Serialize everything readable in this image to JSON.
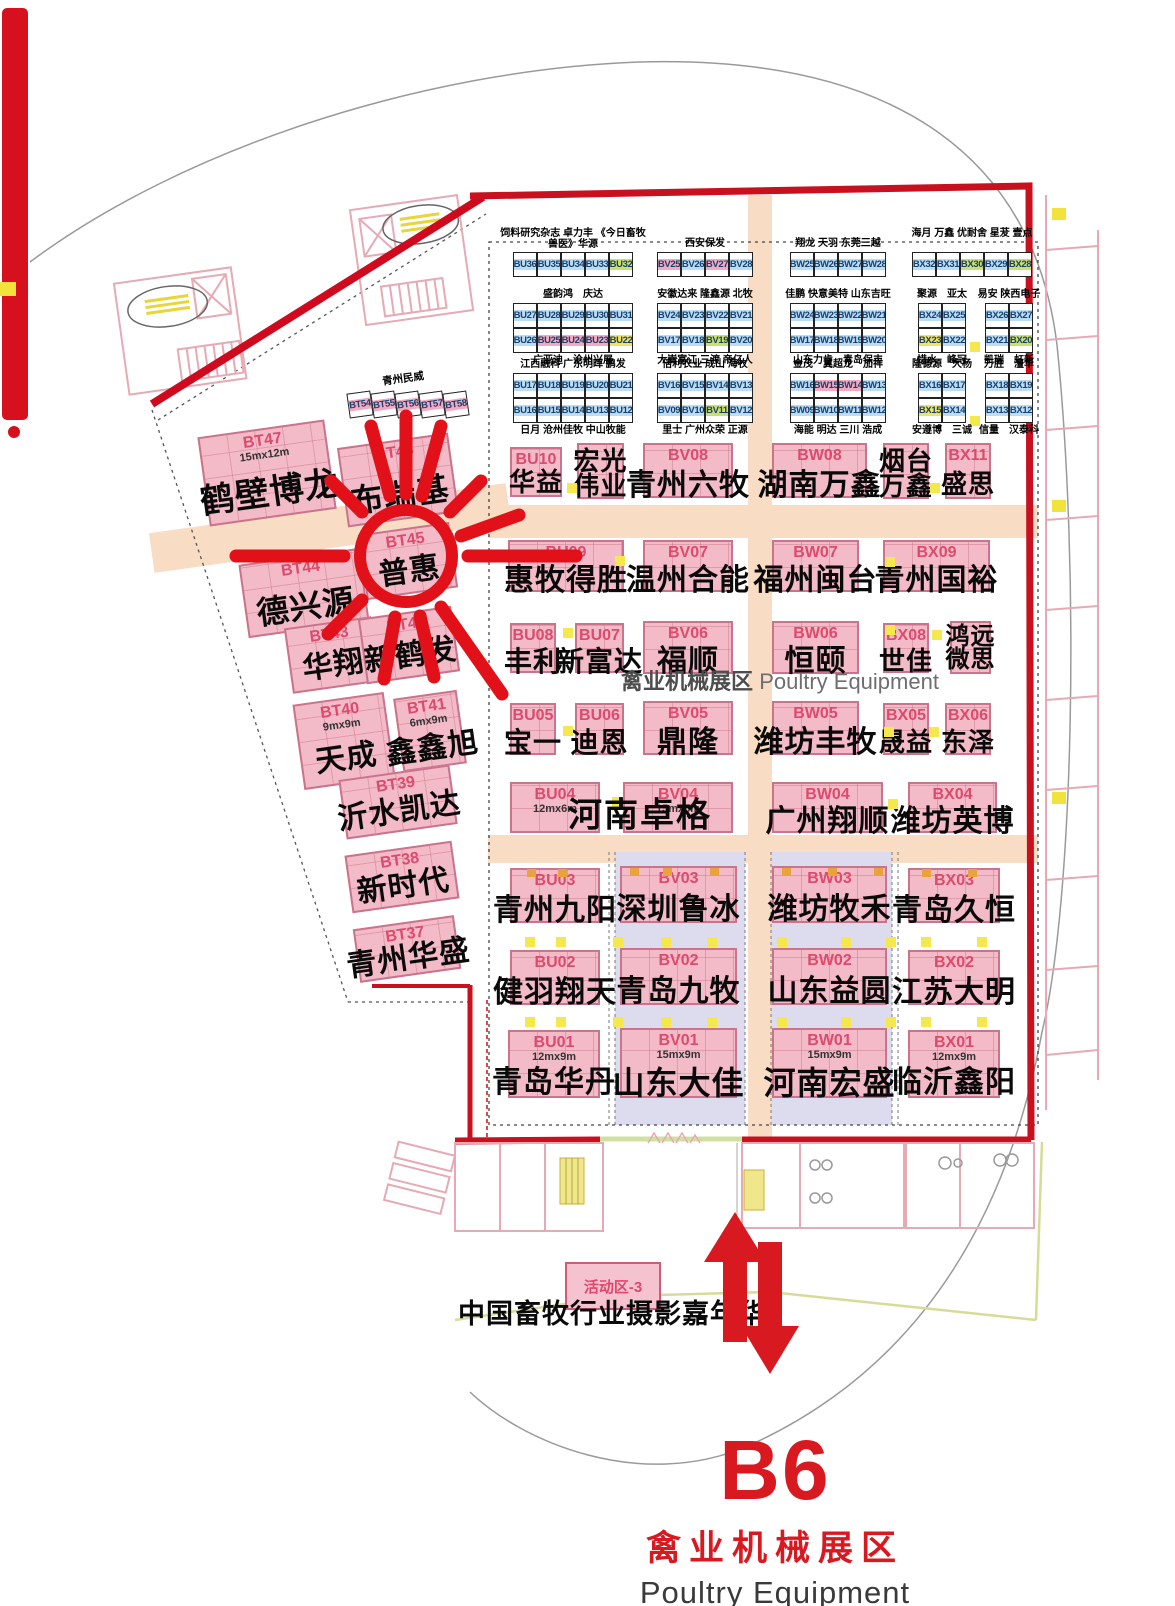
{
  "zone_center_label": {
    "cn": "禽业机械展区",
    "en": "Poultry Equipment"
  },
  "footer": {
    "hall_code": "B6",
    "zone_cn": "禽业机械展区",
    "zone_en": "Poultry Equipment"
  },
  "activity": {
    "booth_label": "活动区-3",
    "title": "中国畜牧行业摄影嘉年华"
  },
  "left_zone": {
    "strip_label": "青州民威",
    "strip_cells": [
      "BT54",
      "BT55",
      "BT56",
      "BT57",
      "BT58"
    ]
  },
  "colors": {
    "booth_pink": "#f3bac7",
    "booth_border": "#c9748c",
    "code_red": "#dd4a6e",
    "corridor_peach": "#f8dcc3",
    "lavender": "#dcdcee",
    "accent_red": "#d91920",
    "boundary_red": "#c9101e",
    "cell_blue": "#badcf4",
    "cell_pink": "#f4a9c0",
    "cell_green": "#cbe06c",
    "cell_yellow": "#f2e35e"
  },
  "top_grid": {
    "highlights": {
      "BU25": "pink",
      "BU24": "pink",
      "BU23": "pink",
      "BU22": "yellow",
      "BV25": "pink",
      "BV27": "pink",
      "BW15": "pink",
      "BW14": "pink",
      "BU32": "green",
      "BV19": "green",
      "BV11": "green",
      "BX30": "green",
      "BX28": "green",
      "BX20": "green",
      "BX23": "yellow",
      "BX15": "yellow"
    },
    "groups": [
      {
        "id": "BU-1",
        "x": 513,
        "y": 252,
        "wrap": true,
        "rows": [
          [
            "BU36",
            "BU35",
            "BU34",
            "BU33",
            "BU32"
          ]
        ],
        "above": "饲料研究杂志 卓力丰 《今日畜牧兽医》华源",
        "below": ""
      },
      {
        "id": "BU-2",
        "x": 513,
        "y": 303,
        "rows": [
          [
            "BU27",
            "BU28",
            "BU29",
            "BU30",
            "BU31"
          ],
          [
            "BU26",
            "BU25",
            "BU24",
            "BU23",
            "BU22"
          ]
        ],
        "above": "盛韵鸿　庆达",
        "below": "广亚迪　沧州兴展"
      },
      {
        "id": "BU-3",
        "x": 513,
        "y": 373,
        "rows": [
          [
            "BU17",
            "BU18",
            "BU19",
            "BU20",
            "BU21"
          ],
          [
            "BU16",
            "BU15",
            "BU14",
            "BU13",
            "BU12"
          ]
        ],
        "above": "江西融科 广东明晖 鹏发",
        "below": "日月 沧州佳牧 中山牧能"
      },
      {
        "id": "BV-1",
        "x": 657,
        "y": 252,
        "rows": [
          [
            "BV25",
            "BV26",
            "BV27",
            "BV28"
          ]
        ],
        "above": "西安保发",
        "below": ""
      },
      {
        "id": "BV-2",
        "x": 657,
        "y": 303,
        "rows": [
          [
            "BV24",
            "BV23",
            "BV22",
            "BV21"
          ],
          [
            "BV17",
            "BV18",
            "BV19",
            "BV20"
          ]
        ],
        "above": "安徽达来 隆鑫源 北牧",
        "below": "大嵩富江 三渡 帝亿人"
      },
      {
        "id": "BV-3",
        "x": 657,
        "y": 373,
        "rows": [
          [
            "BV16",
            "BV15",
            "BV14",
            "BV13"
          ],
          [
            "BV09",
            "BV10",
            "BV11",
            "BV12"
          ]
        ],
        "above": "倍利农业 成山 海牧",
        "below": "里士 广州众荣 正源"
      },
      {
        "id": "BW-1",
        "x": 790,
        "y": 252,
        "rows": [
          [
            "BW25",
            "BW26",
            "BW27",
            "BW28"
          ]
        ],
        "above": "翔龙 天羽 东莞三越",
        "below": ""
      },
      {
        "id": "BW-2",
        "x": 790,
        "y": 303,
        "rows": [
          [
            "BW24",
            "BW23",
            "BW22",
            "BW21"
          ],
          [
            "BW17",
            "BW18",
            "BW19",
            "BW20"
          ]
        ],
        "above": "佳鹏 快意美特 山东吉旺",
        "below": "山东力肯　青岛保丰"
      },
      {
        "id": "BW-3",
        "x": 790,
        "y": 373,
        "rows": [
          [
            "BW16",
            "BW15",
            "BW14",
            "BW13"
          ],
          [
            "BW09",
            "BW10",
            "BW11",
            "BW12"
          ]
        ],
        "above": "金茂　翼超龙　加祥",
        "below": "海能 明达 三川 浩成"
      },
      {
        "id": "BX-1",
        "x": 912,
        "y": 252,
        "wrap": true,
        "rows": [
          [
            "BX32",
            "BX31",
            "BX30",
            "BX29",
            "BX28"
          ]
        ],
        "above": "海月 万鑫 优耐舍 星茇 壹点",
        "below": ""
      },
      {
        "id": "BX-2L",
        "x": 918,
        "y": 303,
        "rows": [
          [
            "BX24",
            "BX25"
          ],
          [
            "BX23",
            "BX22"
          ]
        ],
        "above": "聚源　亚太",
        "below": "惜水　峰冠"
      },
      {
        "id": "BX-2R",
        "x": 985,
        "y": 303,
        "rows": [
          [
            "BX26",
            "BX27"
          ],
          [
            "BX21",
            "BX20"
          ]
        ],
        "above": "易安 陕西电子",
        "below": "凯瑞　虹新"
      },
      {
        "id": "BX-3L",
        "x": 918,
        "y": 373,
        "rows": [
          [
            "BX16",
            "BX17"
          ],
          [
            "BX15",
            "BX14"
          ]
        ],
        "above": "隆德源　大杨",
        "below": "安遵博　三诚"
      },
      {
        "id": "BX-3R",
        "x": 985,
        "y": 373,
        "rows": [
          [
            "BX18",
            "BX19"
          ],
          [
            "BX13",
            "BX12"
          ]
        ],
        "above": "万胜　澶华",
        "below": "信量　汉泰科"
      }
    ]
  },
  "booths": [
    {
      "code": "BU10",
      "name": "华益",
      "x": 510,
      "y": 447,
      "w": 52,
      "h": 50,
      "fs": 26,
      "ny": 45
    },
    {
      "code": "",
      "name": "宏光\n伟业",
      "x": 577,
      "y": 443,
      "w": 47,
      "h": 56,
      "fs": 26,
      "ny": 8
    },
    {
      "code": "BV08",
      "name": "青州六牧",
      "x": 643,
      "y": 443,
      "w": 90,
      "h": 55,
      "fs": 30
    },
    {
      "code": "BW08",
      "name": "湖南万鑫",
      "x": 772,
      "y": 443,
      "w": 95,
      "h": 55,
      "fs": 30
    },
    {
      "code": "",
      "name": "烟台\n万鑫",
      "x": 883,
      "y": 443,
      "w": 46,
      "h": 56,
      "fs": 26,
      "ny": 8
    },
    {
      "code": "BX11",
      "name": "盛思",
      "x": 945,
      "y": 443,
      "w": 46,
      "h": 56,
      "fs": 26
    },
    {
      "code": "BU09",
      "name": "惠牧得胜",
      "x": 508,
      "y": 540,
      "w": 116,
      "h": 52,
      "fs": 30
    },
    {
      "code": "BV07",
      "name": "温州合能",
      "x": 643,
      "y": 540,
      "w": 90,
      "h": 52,
      "fs": 30
    },
    {
      "code": "BW07",
      "name": "福州闽台",
      "x": 772,
      "y": 540,
      "w": 87,
      "h": 52,
      "fs": 30
    },
    {
      "code": "BX09",
      "name": "青州国裕",
      "x": 883,
      "y": 540,
      "w": 107,
      "h": 52,
      "fs": 30
    },
    {
      "code": "BU08",
      "name": "丰利",
      "x": 510,
      "y": 623,
      "w": 46,
      "h": 50,
      "fs": 28
    },
    {
      "code": "BU07",
      "name": "新富达",
      "x": 575,
      "y": 623,
      "w": 49,
      "h": 50,
      "fs": 28
    },
    {
      "code": "BV06",
      "name": "福顺",
      "x": 643,
      "y": 621,
      "w": 90,
      "h": 53,
      "fs": 30
    },
    {
      "code": "BW06",
      "name": "恒颐",
      "x": 772,
      "y": 621,
      "w": 87,
      "h": 53,
      "fs": 30
    },
    {
      "code": "BX08",
      "name": "世佳",
      "x": 883,
      "y": 623,
      "w": 46,
      "h": 50,
      "fs": 26
    },
    {
      "code": "",
      "name": "鸿远\n微思",
      "x": 950,
      "y": 621,
      "w": 41,
      "h": 53,
      "fs": 24,
      "ny": 6
    },
    {
      "code": "BU05",
      "name": "宝一",
      "x": 510,
      "y": 703,
      "w": 46,
      "h": 52,
      "fs": 28
    },
    {
      "code": "BU06",
      "name": "迪恩",
      "x": 575,
      "y": 703,
      "w": 49,
      "h": 52,
      "fs": 28
    },
    {
      "code": "BV05",
      "name": "鼎隆",
      "x": 643,
      "y": 701,
      "w": 90,
      "h": 54,
      "fs": 30
    },
    {
      "code": "BW05",
      "name": "潍坊丰牧",
      "x": 772,
      "y": 701,
      "w": 87,
      "h": 54,
      "fs": 30
    },
    {
      "code": "BX05",
      "name": "晟益",
      "x": 883,
      "y": 703,
      "w": 46,
      "h": 52,
      "fs": 26
    },
    {
      "code": "BX06",
      "name": "东泽",
      "x": 945,
      "y": 703,
      "w": 46,
      "h": 52,
      "fs": 26
    },
    {
      "code": "BU04",
      "name": "",
      "size": "12mx6m",
      "x": 510,
      "y": 782,
      "w": 90,
      "h": 51
    },
    {
      "code": "BV04",
      "name": "",
      "size": "15mx6m",
      "x": 623,
      "y": 782,
      "w": 110,
      "h": 51
    },
    {
      "code": "BW04",
      "name": "广州翔顺",
      "x": 772,
      "y": 782,
      "w": 111,
      "h": 51,
      "fs": 30
    },
    {
      "code": "BX04",
      "name": "潍坊英博",
      "x": 908,
      "y": 782,
      "w": 89,
      "h": 51,
      "fs": 30
    },
    {
      "code": "BU03",
      "name": "青州九阳",
      "x": 510,
      "y": 868,
      "w": 90,
      "h": 55,
      "fs": 30
    },
    {
      "code": "BV03",
      "name": "深圳鲁冰",
      "x": 620,
      "y": 866,
      "w": 117,
      "h": 57,
      "fs": 30
    },
    {
      "code": "BW03",
      "name": "潍坊牧禾",
      "x": 772,
      "y": 866,
      "w": 115,
      "h": 57,
      "fs": 30
    },
    {
      "code": "BX03",
      "name": "青岛久恒",
      "x": 908,
      "y": 868,
      "w": 92,
      "h": 55,
      "fs": 30
    },
    {
      "code": "BU02",
      "name": "健羽翔天",
      "x": 510,
      "y": 950,
      "w": 90,
      "h": 55,
      "fs": 30
    },
    {
      "code": "BV02",
      "name": "青岛九牧",
      "x": 620,
      "y": 948,
      "w": 117,
      "h": 57,
      "fs": 30
    },
    {
      "code": "BW02",
      "name": "山东益圆",
      "x": 772,
      "y": 948,
      "w": 115,
      "h": 57,
      "fs": 30
    },
    {
      "code": "BX02",
      "name": "江苏大明",
      "x": 908,
      "y": 950,
      "w": 92,
      "h": 55,
      "fs": 30
    },
    {
      "code": "BU01",
      "name": "青岛华丹",
      "size": "12mx9m",
      "x": 508,
      "y": 1030,
      "w": 92,
      "h": 68,
      "fs": 30,
      "ny": 58
    },
    {
      "code": "BV01",
      "name": "山东大佳",
      "size": "15mx9m",
      "x": 620,
      "y": 1028,
      "w": 117,
      "h": 70,
      "fs": 32,
      "ny": 58
    },
    {
      "code": "BW01",
      "name": "河南宏盛",
      "size": "15mx9m",
      "x": 772,
      "y": 1028,
      "w": 115,
      "h": 70,
      "fs": 32,
      "ny": 58
    },
    {
      "code": "BX01",
      "name": "临沂鑫阳",
      "size": "12mx9m",
      "x": 908,
      "y": 1030,
      "w": 92,
      "h": 68,
      "fs": 30,
      "ny": 58
    }
  ],
  "left_booths": [
    {
      "code": "BT47",
      "name": "鹤壁博龙",
      "size": "15mx12m",
      "x": 203,
      "y": 428,
      "w": 128,
      "h": 90,
      "fs": 34,
      "ny": 55
    },
    {
      "code": "BT46",
      "name": "布瑞基",
      "x": 342,
      "y": 440,
      "w": 112,
      "h": 80,
      "fs": 32,
      "ny": 50
    },
    {
      "code": "BT45",
      "name": "普惠",
      "x": 362,
      "y": 528,
      "w": 92,
      "h": 66,
      "fs": 30,
      "ny": 45
    },
    {
      "code": "BT44",
      "name": "德兴源",
      "x": 243,
      "y": 556,
      "w": 122,
      "h": 74,
      "fs": 32,
      "ny": 48
    },
    {
      "code": "BT43",
      "name": "华翔",
      "x": 288,
      "y": 622,
      "w": 88,
      "h": 66,
      "fs": 30,
      "ny": 45
    },
    {
      "code": "BT42",
      "name": "新鹤发",
      "x": 362,
      "y": 612,
      "w": 94,
      "h": 66,
      "fs": 30,
      "ny": 45
    },
    {
      "code": "BT40",
      "name": "天成",
      "size": "9mx9m",
      "x": 298,
      "y": 698,
      "w": 92,
      "h": 86,
      "fs": 30,
      "ny": 55
    },
    {
      "code": "BT41",
      "name": "鑫鑫旭",
      "size": "6mx9m",
      "x": 398,
      "y": 694,
      "w": 64,
      "h": 74,
      "fs": 30,
      "ny": 55
    },
    {
      "code": "BT39",
      "name": "沂水凯达",
      "x": 342,
      "y": 772,
      "w": 112,
      "h": 60,
      "fs": 30,
      "ny": 42
    },
    {
      "code": "BT38",
      "name": "新时代",
      "x": 348,
      "y": 848,
      "w": 108,
      "h": 58,
      "fs": 30,
      "ny": 42
    },
    {
      "code": "BT37",
      "name": "青州华盛",
      "x": 356,
      "y": 922,
      "w": 102,
      "h": 54,
      "fs": 30,
      "ny": 42
    }
  ],
  "floating_names": [
    {
      "text": "河南卓格",
      "x": 640,
      "y": 812,
      "fs": 34
    }
  ],
  "markers": {
    "yellow": [
      [
        567,
        483
      ],
      [
        930,
        483
      ],
      [
        615,
        556
      ],
      [
        885,
        557
      ],
      [
        563,
        628
      ],
      [
        885,
        625
      ],
      [
        932,
        630
      ],
      [
        563,
        726
      ],
      [
        884,
        727
      ],
      [
        929,
        727
      ],
      [
        612,
        797
      ],
      [
        888,
        799
      ],
      [
        970,
        342
      ],
      [
        970,
        416
      ],
      [
        525,
        937
      ],
      [
        556,
        937
      ],
      [
        613,
        937
      ],
      [
        661,
        937
      ],
      [
        707,
        937
      ],
      [
        777,
        937
      ],
      [
        841,
        937
      ],
      [
        886,
        937
      ],
      [
        921,
        937
      ],
      [
        977,
        937
      ],
      [
        525,
        1017
      ],
      [
        556,
        1017
      ],
      [
        613,
        1017
      ],
      [
        661,
        1017
      ],
      [
        707,
        1017
      ],
      [
        777,
        1017
      ],
      [
        841,
        1017
      ],
      [
        886,
        1017
      ],
      [
        921,
        1017
      ],
      [
        977,
        1017
      ]
    ],
    "orange": [
      [
        527,
        869
      ],
      [
        558,
        869
      ],
      [
        630,
        868
      ],
      [
        663,
        868
      ],
      [
        710,
        868
      ],
      [
        782,
        868
      ],
      [
        828,
        868
      ],
      [
        874,
        868
      ],
      [
        922,
        869
      ],
      [
        968,
        869
      ]
    ]
  }
}
